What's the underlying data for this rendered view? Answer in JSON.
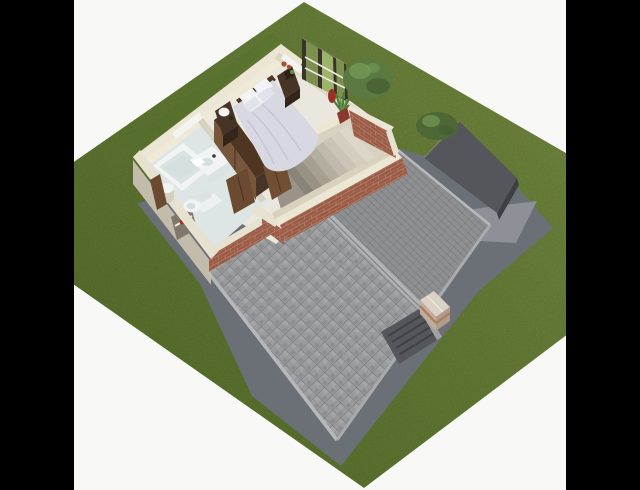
{
  "scene": {
    "kind": "3d-floorplan-render",
    "view": "aerial dollhouse cutaway of upper floor over roof, lawn around, pillarboxed",
    "rooms": [
      "bedroom",
      "bathroom",
      "stair-void"
    ],
    "objects": [
      "double-bed",
      "pillows",
      "nightstand-left",
      "nightstand-right",
      "table-lamp",
      "wardrobe",
      "bathtub",
      "vanity-sink",
      "toilet",
      "laundry-hamper",
      "bath-cabinet",
      "french-window",
      "potted-plant",
      "tree",
      "garage-flat-roof",
      "garage-bush",
      "shingle-roof",
      "ridge-cap",
      "chimney",
      "roof-hatch",
      "staircase",
      "doors",
      "brick-parapet",
      "garden-apron",
      "niche-flowers"
    ]
  },
  "palette": {
    "bg": "#f8f8f6",
    "bar": "#000000",
    "grass_light": "#8fa84e",
    "grass_mid": "#7d9c42",
    "grass_dark": "#6d8a37",
    "apron": "#6b6f76",
    "slab": "#8d9096",
    "garage_roof": "#55565b",
    "garage_side": "#3e3f44",
    "roof_west": "#9a9b9d",
    "roof_east": "#8e8f91",
    "ridge": "#b1b3b4",
    "fascia": "#b7b8ba",
    "eave_line": "#a9abad",
    "inset_dark": "#54565b",
    "inset_frame": "#a0a2a4",
    "inset_step": "#3f4145",
    "chimney_top": "#dad2c7",
    "chimney_sw": "#c3ac99",
    "chimney_se": "#b29b89",
    "chimney_band": "#a77e64",
    "wall_cap": "#ece6d4",
    "wall_cap2": "#e7e1cf",
    "wall_in_light": "#efe9d8",
    "wall_in_mid": "#ded7c2",
    "wall_in_dark": "#d8d1bd",
    "wall_out_sw": "#c3bcaa",
    "brick": "#9a5a45",
    "brick_mortar": "#b08068",
    "floor_bed": "#eae7de",
    "floor_bath": "#dde6e4",
    "mat_white": "#ecf1ef",
    "white_fix": "#f2f4f3",
    "fix_shadow": "#dbe3e2",
    "fix_inner": "#d3e0df",
    "wood_dark": "#463426",
    "wood_darker": "#332519",
    "wood_mid": "#77573c",
    "wood_top": "#4e3622",
    "wood_door": "#6b4a31",
    "wood_door2": "#714f34",
    "duvet": "#d7d8e2",
    "duvet_shadow": "#c3c4d3",
    "pillow": "#f4f4f6",
    "pillow2": "#e2e2ea",
    "sheet": "#f0f0f4",
    "lamp": "#f6f5f1",
    "hamper": "#d6cfbd",
    "window_frame": "#3a332b",
    "glass_green": "#7c9150",
    "glass_light": "#9db36a",
    "rail_white": "#eceee8",
    "plant_green": "#4f7a3a",
    "plant_light": "#639448",
    "flower_red": "#9c2f24",
    "rust": "#a8502e",
    "pot": "#8a3a2c",
    "tree": "#5a7a42",
    "tree_light": "#739a55",
    "tree_dark": "#465f33",
    "bush": "#4d6834",
    "void_top": "#d8d2c2",
    "landing": "#9a9488",
    "niche_dark": "#80786a",
    "white_band": "#f3f3ef",
    "tread0": "#dcd7c8",
    "tread1": "#d3cebf",
    "tread2": "#c9c4b5",
    "tread3": "#bfbaab",
    "tread4": "#b3ae9f",
    "tread5": "#a5a092",
    "tread6": "#979284",
    "tread7": "#898478"
  }
}
